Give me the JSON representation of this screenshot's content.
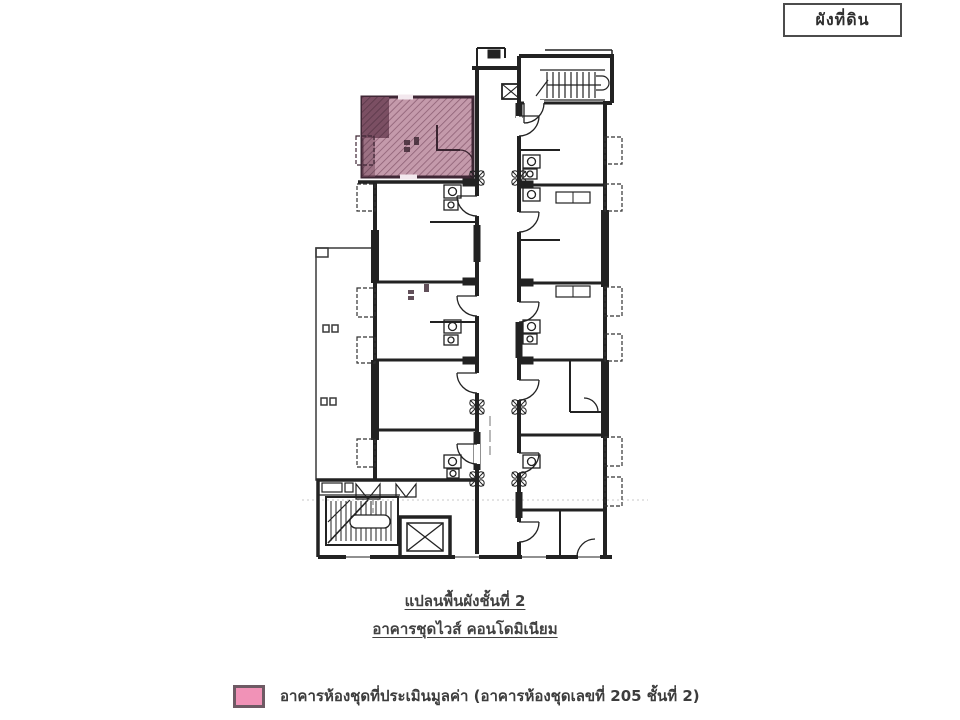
{
  "title_box": {
    "label": "ผังที่ดิน"
  },
  "plan": {
    "captions": {
      "line1": "แปลนพื้นผังชั้นที่ 2",
      "line2": "อาคารชุดไวส์ คอนโดมิเนียม"
    },
    "ink": "#222222",
    "highlight": {
      "fill": "#c49aab",
      "hatch": "#8d5f74",
      "dark_fill": "#7b4f63",
      "hatch_dark": "#5a3748",
      "border": "#3f2735"
    }
  },
  "legend": {
    "label": "อาคารห้องชุดที่ประเมินมูลค่า (อาคารห้องชุดเลขที่ 205 ชั้นที่ 2)",
    "swatch_color": "#f192b7",
    "swatch_border": "#6e5a64"
  }
}
